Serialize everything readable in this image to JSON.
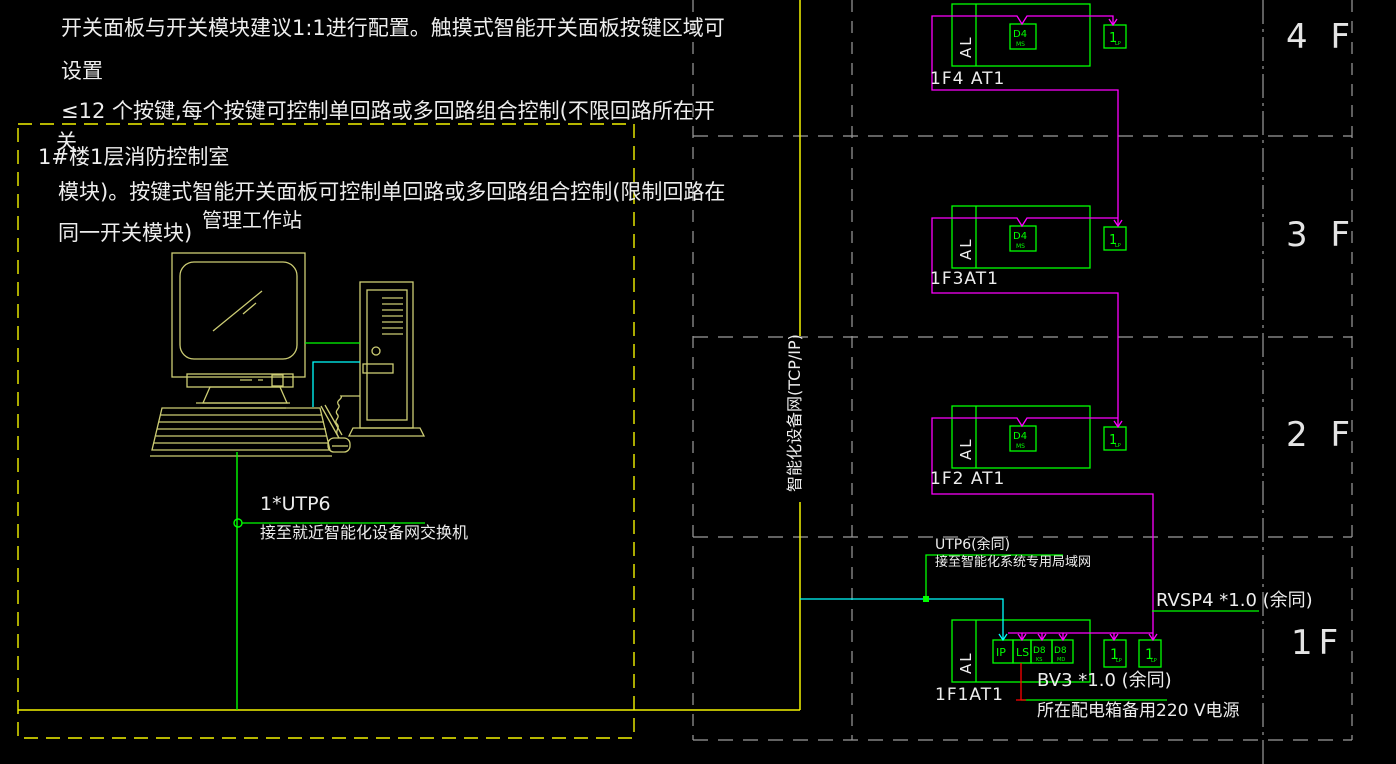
{
  "notes": {
    "line1": "开关面板与开关模块建议1:1进行配置。触摸式智能开关面板按键区域可",
    "line2": "设置",
    "line3": "≤12 个按键,每个按键可控制单回路或多回路组合控制(不限回路所在开",
    "line4": "关",
    "line5": "模块)。按键式智能开关面板可控制单回路或多回路组合控制(限制回路在",
    "line6": "同一开关模块)"
  },
  "control_room": {
    "label": "1#楼1层消防控制室",
    "workstation_label": "管理工作站",
    "uplink_label": "1*UTP6",
    "uplink_desc": "接至就近智能化设备网交换机"
  },
  "backbone": {
    "label": "智能化设备网(TCP/IP)"
  },
  "floors": [
    {
      "name": "4 F",
      "at_label": "1F4 AT1",
      "al": "AL",
      "module": "D4",
      "module_sub": "MS",
      "panel": "1",
      "panel_sub": "LP"
    },
    {
      "name": "3 F",
      "at_label": "1F3AT1",
      "al": "AL",
      "module": "D4",
      "module_sub": "MS",
      "panel": "1",
      "panel_sub": "LP"
    },
    {
      "name": "2 F",
      "at_label": "1F2 AT1",
      "al": "AL",
      "module": "D4",
      "module_sub": "MS",
      "panel": "1",
      "panel_sub": "LP"
    },
    {
      "name": "1F",
      "at_label": "1F1AT1",
      "al": "AL",
      "modules": [
        {
          "label": "IP"
        },
        {
          "label": "LS"
        },
        {
          "label": "D8",
          "sub": "KS"
        },
        {
          "label": "D8",
          "sub": "MD"
        }
      ],
      "panels": [
        {
          "label": "1",
          "sub": "LP"
        },
        {
          "label": "1",
          "sub": "LP"
        }
      ]
    }
  ],
  "cables": {
    "lan": {
      "label": "UTP6(余同)",
      "desc": "接至智能化系统专用局域网"
    },
    "bus": {
      "label": "RVSP4 *1.0 (余同)"
    },
    "power": {
      "label": "BV3 *1.0 (余同)",
      "desc": "所在配电箱备用220 V电源"
    }
  },
  "colors": {
    "background": "#000000",
    "wire_green": "#00FF00",
    "wire_magenta": "#FF00FF",
    "wire_cyan": "#00FFFF",
    "wire_red": "#FF0000",
    "trunk_yellow": "#F2F200",
    "grid_gray": "#9C9C9C",
    "text_white": "#EDEDED",
    "equipment_khaki": "#CDCD74"
  }
}
